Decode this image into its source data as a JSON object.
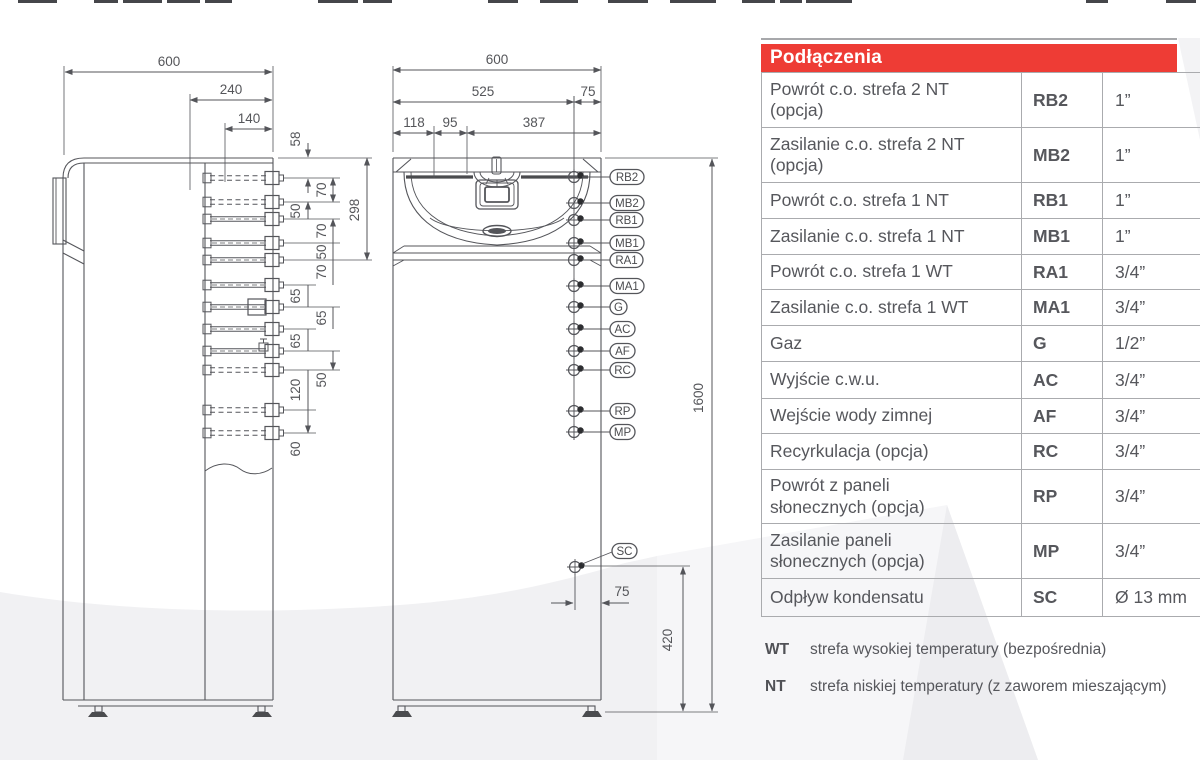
{
  "colors": {
    "header_bg": "#ee3c35",
    "header_text": "#ffffff",
    "table_text": "#56575c",
    "drawing_line": "#54555a",
    "watermark_gray": "#f1f1f3"
  },
  "side_view": {
    "top_dims": [
      "600",
      "240",
      "140"
    ],
    "col1_dims": [
      "58",
      "50",
      "65",
      "65",
      "120",
      "60"
    ],
    "col2_dims": [
      "70",
      "70",
      "50",
      "70",
      "65",
      "50"
    ],
    "span_dim": "298"
  },
  "front_view": {
    "top_dims": [
      "600",
      "525",
      "75",
      "118",
      "95",
      "387"
    ],
    "height_dim": "1600",
    "base_dim": "420",
    "sc_offset_dim": "75",
    "connections": [
      "RB2",
      "MB2",
      "RB1",
      "MB1",
      "RA1",
      "MA1",
      "G",
      "AC",
      "AF",
      "RC",
      "RP",
      "MP",
      "SC"
    ]
  },
  "table": {
    "header": "Podłączenia",
    "rows": [
      {
        "name": "Powrót c.o. strefa 2 NT\n(opcja)",
        "code": "RB2",
        "size": "1”"
      },
      {
        "name": "Zasilanie c.o. strefa 2 NT\n(opcja)",
        "code": "MB2",
        "size": "1”"
      },
      {
        "name": "Powrót c.o. strefa 1 NT",
        "code": "RB1",
        "size": "1”"
      },
      {
        "name": "Zasilanie c.o. strefa 1 NT",
        "code": "MB1",
        "size": "1”"
      },
      {
        "name": "Powrót c.o. strefa 1 WT",
        "code": "RA1",
        "size": "3/4”"
      },
      {
        "name": "Zasilanie c.o. strefa 1 WT",
        "code": "MA1",
        "size": "3/4”"
      },
      {
        "name": "Gaz",
        "code": "G",
        "size": "1/2”"
      },
      {
        "name": "Wyjście c.w.u.",
        "code": "AC",
        "size": "3/4”"
      },
      {
        "name": "Wejście wody zimnej",
        "code": "AF",
        "size": "3/4”"
      },
      {
        "name": "Recyrkulacja (opcja)",
        "code": "RC",
        "size": "3/4”"
      },
      {
        "name": "Powrót z paneli\nsłonecznych (opcja)",
        "code": "RP",
        "size": "3/4”"
      },
      {
        "name": "Zasilanie paneli\nsłonecznych (opcja)",
        "code": "MP",
        "size": "3/4”"
      },
      {
        "name": "Odpływ kondensatu",
        "code": "SC",
        "size": "Ø 13 mm"
      }
    ],
    "footnotes": [
      {
        "code": "WT",
        "text": "strefa wysokiej temperatury (bezpośrednia)"
      },
      {
        "code": "NT",
        "text": "strefa niskiej temperatury (z zaworem mieszającym)"
      }
    ]
  }
}
